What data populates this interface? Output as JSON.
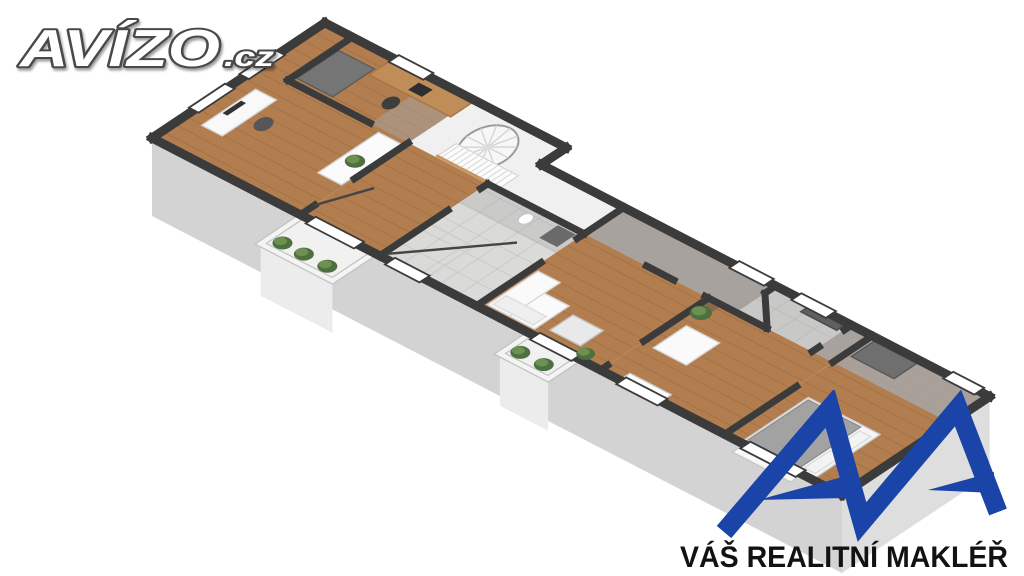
{
  "page": {
    "background": "#ffffff",
    "description": "3D isometric floor plan render of an apartment, real-estate listing image"
  },
  "logo_avizo": {
    "text_main": "AVÍZO",
    "text_suffix": ".cz",
    "fill": "#ffffff",
    "outline": "#4a4a4a"
  },
  "logo_broker": {
    "tagline": "VÁŠ REALITNÍ MAKLÉŘ",
    "text_color": "#121212",
    "mark_color": "#1b44a8"
  },
  "floorplan": {
    "iso": {
      "x0": 152,
      "y0": 138,
      "ux": 0.69,
      "uy": 0.357,
      "vx": 0.72,
      "vy": -0.48,
      "drop": 78
    },
    "colors": {
      "wallTop": "#3b3b3b",
      "faceEnd": "#e6e6e6",
      "faceSide": "#d3d3d3",
      "faceFar": "#dedede",
      "wood": "#b27e4f",
      "woodLine": "rgba(70,35,10,0.13)",
      "tile": "#dadad8",
      "tileLine": "rgba(0,0,0,0.07)",
      "whiteFloor": "#f0f0f0",
      "shadow": "#a6a6a6",
      "balconyFloor": "#f1f1f1",
      "balconyFace": "#ececec",
      "parapet": "#f4f4f4",
      "parapetEdge": "#c2c2c2",
      "plantDark": "#4e6f3e",
      "plantLight": "#6d9153",
      "glass": "#454545",
      "window": "#ffffff",
      "trim": "#c8945f"
    },
    "rooms": [
      {
        "name": "office",
        "floor": "wood"
      },
      {
        "name": "study-nook",
        "floor": "wood"
      },
      {
        "name": "hallway",
        "floor": "wood"
      },
      {
        "name": "bathroom",
        "floor": "tile"
      },
      {
        "name": "staircase-hall",
        "floor": "white"
      },
      {
        "name": "living-room",
        "floor": "wood"
      },
      {
        "name": "corridor",
        "floor": "wood"
      },
      {
        "name": "bedroom",
        "floor": "wood"
      },
      {
        "name": "bathroom-2",
        "floor": "tile"
      },
      {
        "name": "bedroom-2",
        "floor": "wood"
      }
    ],
    "faces": [
      {
        "a": [
          0,
          0
        ],
        "b": [
          0,
          240
        ],
        "f": "faceEnd"
      },
      {
        "a": [
          0,
          0
        ],
        "b": [
          1000,
          0
        ],
        "f": "faceSide"
      },
      {
        "a": [
          1000,
          0
        ],
        "b": [
          1000,
          205
        ],
        "f": "faceFar"
      }
    ],
    "floors": [
      {
        "r": [
          0,
          0,
          215,
          240
        ],
        "t": "wood"
      },
      {
        "r": [
          215,
          0,
          115,
          150
        ],
        "t": "wood"
      },
      {
        "poly": [
          [
            215,
            150
          ],
          [
            470,
            150
          ],
          [
            470,
            205
          ],
          [
            350,
            205
          ],
          [
            350,
            240
          ],
          [
            215,
            240
          ]
        ],
        "t": "white"
      },
      {
        "r": [
          330,
          0,
          140,
          150
        ],
        "t": "tile"
      },
      {
        "r": [
          470,
          0,
          180,
          150
        ],
        "t": "wood"
      },
      {
        "r": [
          470,
          150,
          360,
          55
        ],
        "t": "wood"
      },
      {
        "r": [
          650,
          0,
          180,
          150
        ],
        "t": "wood"
      },
      {
        "r": [
          690,
          150,
          110,
          55
        ],
        "t": "tile"
      },
      {
        "r": [
          830,
          0,
          170,
          205
        ],
        "t": "wood"
      }
    ],
    "shadows": [
      {
        "r": [
          160,
          150,
          55,
          90
        ],
        "o": 0.5
      },
      {
        "r": [
          330,
          110,
          140,
          40
        ],
        "o": 0.3
      },
      {
        "r": [
          470,
          150,
          220,
          55
        ],
        "o": 0.9
      },
      {
        "r": [
          690,
          150,
          110,
          55
        ],
        "o": 0.35
      },
      {
        "r": [
          800,
          150,
          30,
          55
        ],
        "o": 0.9
      },
      {
        "r": [
          830,
          150,
          170,
          55
        ],
        "o": 0.85
      }
    ],
    "walls": {
      "outer": [
        [
          0,
          0,
          0,
          240
        ],
        [
          0,
          240,
          350,
          240
        ],
        [
          350,
          240,
          350,
          205
        ],
        [
          350,
          205,
          1000,
          205
        ],
        [
          1000,
          205,
          1000,
          0
        ],
        [
          1000,
          0,
          0,
          0
        ]
      ],
      "inner": [
        [
          40,
          150,
          160,
          150
        ],
        [
          40,
          150,
          40,
          240
        ],
        [
          215,
          0,
          215,
          20
        ],
        [
          215,
          75,
          215,
          150
        ],
        [
          330,
          0,
          330,
          95
        ],
        [
          330,
          140,
          330,
          150
        ],
        [
          330,
          150,
          470,
          150
        ],
        [
          470,
          0,
          470,
          90
        ],
        [
          470,
          140,
          470,
          150
        ],
        [
          470,
          150,
          470,
          205
        ],
        [
          560,
          150,
          600,
          150
        ],
        [
          645,
          150,
          735,
          150
        ],
        [
          735,
          150,
          690,
          190
        ],
        [
          690,
          190,
          690,
          205
        ],
        [
          650,
          0,
          650,
          10
        ],
        [
          650,
          60,
          650,
          150
        ],
        [
          800,
          150,
          800,
          160
        ],
        [
          800,
          195,
          800,
          205
        ],
        [
          830,
          0,
          830,
          100
        ],
        [
          830,
          150,
          830,
          205
        ]
      ]
    },
    "windows": [
      [
        -7,
        58,
        14,
        50
      ],
      [
        -7,
        128,
        14,
        50
      ],
      [
        100,
        233,
        50,
        14
      ],
      [
        630,
        198,
        50,
        14
      ],
      [
        720,
        198,
        50,
        14
      ],
      [
        940,
        198,
        45,
        14
      ],
      [
        230,
        -7,
        70,
        14
      ],
      [
        345,
        -7,
        50,
        14
      ],
      [
        555,
        -7,
        60,
        14
      ],
      [
        680,
        -7,
        60,
        14
      ],
      [
        860,
        -7,
        80,
        14
      ]
    ],
    "glass": [
      [
        215,
        20,
        242,
        75
      ],
      [
        335,
        8,
        425,
        98
      ]
    ],
    "balconies": [
      {
        "x": 218,
        "w": 104,
        "d": 58,
        "plants": [
          235,
          266,
          300
        ]
      },
      {
        "x": 548,
        "w": 70,
        "d": 42,
        "plants": [
          563,
          597
        ]
      }
    ],
    "furniture": [
      {
        "s": "r",
        "name": "desk",
        "b": [
          25,
          45,
          30,
          75
        ],
        "f": "#f9f9f9",
        "st": "#d6d6d6"
      },
      {
        "s": "r",
        "name": "monitor",
        "b": [
          27,
          72,
          7,
          26
        ],
        "f": "#333333"
      },
      {
        "s": "e",
        "name": "office-chair",
        "c": [
          74,
          84
        ],
        "r": 13,
        "f": "#565656"
      },
      {
        "s": "r",
        "name": "dresser",
        "b": [
          178,
          60,
          34,
          84
        ],
        "f": "#fbfbfb",
        "st": "#d6d6d6"
      },
      {
        "s": "r",
        "name": "wardrobe",
        "b": [
          45,
          158,
          52,
          58
        ],
        "f": "#757575",
        "st": "#5c5c5c"
      },
      {
        "s": "r",
        "name": "study-desk",
        "b": [
          100,
          206,
          118,
          30
        ],
        "f": "#c08c58",
        "st": "#a8763f"
      },
      {
        "s": "r",
        "name": "study-monitor",
        "b": [
          150,
          212,
          20,
          15
        ],
        "f": "#2e2e2e"
      },
      {
        "s": "e",
        "name": "study-chair",
        "c": [
          152,
          186
        ],
        "r": 12,
        "f": "#3e3e3e"
      },
      {
        "s": "r",
        "name": "shower-tray",
        "b": [
          333,
          6,
          62,
          62
        ],
        "f": "none",
        "st": "#cfcfcf",
        "w": 2
      },
      {
        "s": "r",
        "name": "sink-cabinet",
        "b": [
          438,
          118,
          26,
          26
        ],
        "f": "#6a6a6a"
      },
      {
        "s": "e",
        "name": "toilet",
        "c": [
          404,
          132
        ],
        "r": 10,
        "f": "#ffffff",
        "st": "#c5c5c5"
      },
      {
        "s": "r",
        "name": "sofa",
        "b": [
          478,
          8,
          68,
          48
        ],
        "f": "#fafafa",
        "st": "#d8d8d8"
      },
      {
        "s": "r",
        "name": "sofa-chaise",
        "b": [
          478,
          8,
          32,
          70
        ],
        "f": "#fafafa",
        "st": "#d8d8d8"
      },
      {
        "s": "r",
        "name": "sofa-cushions",
        "b": [
          482,
          12,
          58,
          18
        ],
        "f": "#efefef",
        "st": "#dddddd"
      },
      {
        "s": "r",
        "name": "coffee-table",
        "b": [
          560,
          16,
          44,
          32
        ],
        "f": "#e9e9e9",
        "st": "#c0c0c0"
      },
      {
        "s": "r",
        "name": "radiator",
        "b": [
          678,
          4,
          60,
          10
        ],
        "f": "#fdfdfd",
        "st": "#cfcfcf"
      },
      {
        "s": "r",
        "name": "armchair",
        "b": [
          666,
          58,
          48,
          46
        ],
        "f": "#fafafa",
        "st": "#d8d8d8"
      },
      {
        "s": "r",
        "name": "plant-pot",
        "b": [
          654,
          134,
          16,
          12
        ],
        "f": "#8a6a48"
      },
      {
        "s": "r",
        "name": "vanity-counter",
        "b": [
          742,
          190,
          52,
          14
        ],
        "f": "#606060",
        "st": "#4a4a4a"
      },
      {
        "s": "r",
        "name": "closet",
        "b": [
          838,
          168,
          62,
          34
        ],
        "f": "#6f6f6f",
        "st": "#575757"
      },
      {
        "s": "r",
        "name": "window-sill",
        "b": [
          858,
          -16,
          84,
          16
        ],
        "f": "#f8f8f8",
        "st": "#c9c9c9"
      },
      {
        "s": "r",
        "name": "bed-frame",
        "b": [
          853,
          2,
          104,
          92
        ],
        "f": "#f6f6f6",
        "st": "#cfcfcf"
      },
      {
        "s": "r",
        "name": "bed-duvet",
        "b": [
          856,
          5,
          76,
          86
        ],
        "f": "#a2a2a2",
        "st": "#8f8f8f"
      },
      {
        "s": "r",
        "name": "bed-pillow",
        "b": [
          936,
          9,
          16,
          36
        ],
        "f": "#f3f3f3",
        "st": "#dcdcdc"
      },
      {
        "s": "r",
        "name": "bed-pillow",
        "b": [
          936,
          50,
          16,
          36
        ],
        "f": "#f3f3f3",
        "st": "#dcdcdc"
      }
    ],
    "spiral_stair": {
      "c": [
        285,
        193
      ],
      "r": 40
    },
    "stair_stripes": {
      "r": [
        255,
        152,
        90,
        26
      ],
      "step": 7
    },
    "plants": [
      {
        "c": [
          194,
          96
        ],
        "r": 12
      },
      {
        "c": [
          618,
          10
        ],
        "r": 11
      },
      {
        "c": [
          662,
          128
        ],
        "r": 13
      }
    ]
  }
}
